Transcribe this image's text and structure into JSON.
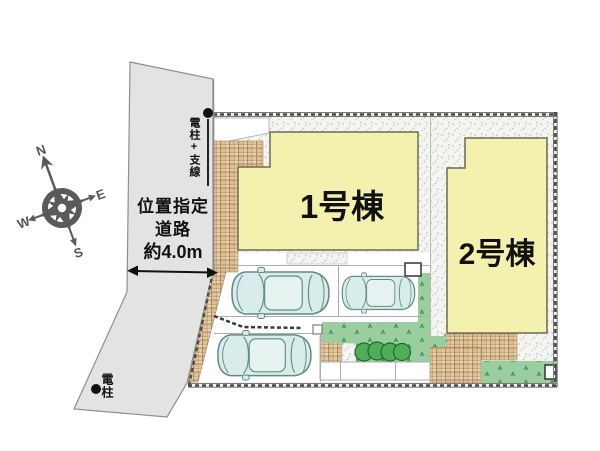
{
  "site_plan": {
    "title": "分譲地 区画図",
    "buildings": [
      {
        "label": "1号棟"
      },
      {
        "label": "2号棟"
      }
    ],
    "road": {
      "label_lines": [
        "位置指定",
        "道路",
        "約4.0m"
      ],
      "width_note": "約4.0m"
    },
    "poles": {
      "top": "電柱+支線",
      "bottom": "電柱"
    },
    "compass": {
      "n": "N",
      "e": "E",
      "s": "S",
      "w": "W"
    },
    "counts": {
      "cars": 3,
      "shrubs": 4
    },
    "colors": {
      "building": "#f4f1ae",
      "lawn": "#9bce9e",
      "tile": "#e4c89e",
      "road": "#e3e3e3",
      "car": "#d8edea",
      "boundary": "#4a4a4a",
      "stipple_base": "#f4f4f1"
    }
  }
}
